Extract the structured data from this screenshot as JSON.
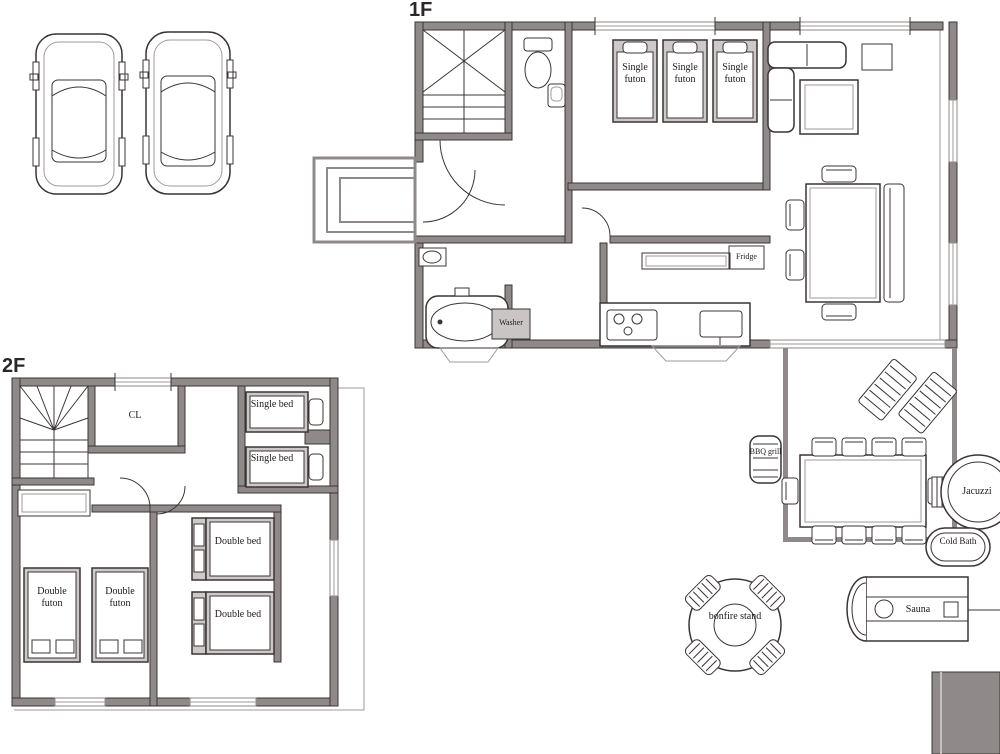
{
  "floor_1f": {
    "label": "1F",
    "furniture": {
      "single_futon": "Single futon",
      "fridge": "Fridge",
      "washer": "Washer"
    }
  },
  "floor_2f": {
    "label": "2F",
    "furniture": {
      "closet": "CL",
      "single_bed": "Single bed",
      "double_bed": "Double bed",
      "double_futon": "Double futon"
    }
  },
  "outdoor": {
    "bbq_grill": "BBQ grill",
    "jacuzzi": "Jacuzzi",
    "cold_bath": "Cold Bath",
    "sauna": "Sauna",
    "bonfire_stand": "bonfire stand"
  },
  "colors": {
    "line": "#3a3534",
    "wall_fill": "#8f8a89",
    "light_line": "#9f9b9a",
    "background": "#ffffff"
  }
}
